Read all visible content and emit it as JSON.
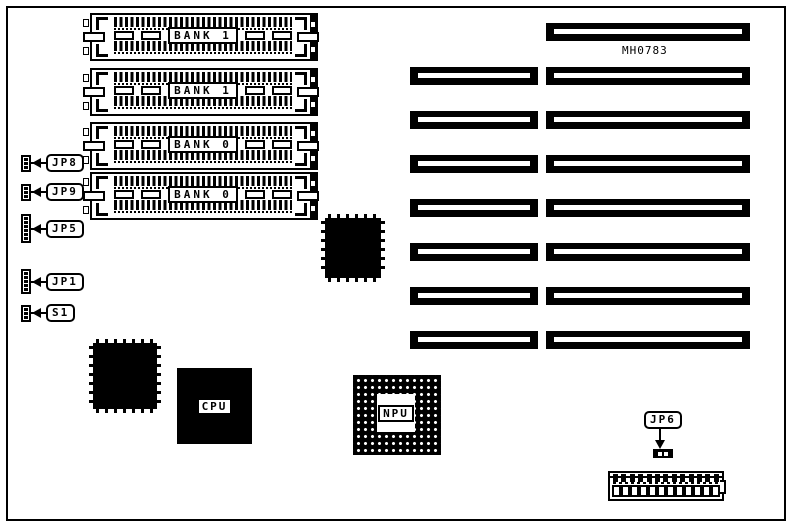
{
  "board": {
    "id_label": "MH0783",
    "colors": {
      "ink": "#000000",
      "paper": "#ffffff"
    }
  },
  "memory_banks": [
    {
      "label": "BANK 1"
    },
    {
      "label": "BANK 1"
    },
    {
      "label": "BANK 0"
    },
    {
      "label": "BANK 0"
    }
  ],
  "jumpers": [
    {
      "label": "JP8"
    },
    {
      "label": "JP9"
    },
    {
      "label": "JP5"
    },
    {
      "label": "JP1"
    },
    {
      "label": "S1"
    },
    {
      "label": "JP6"
    }
  ],
  "chips": {
    "cpu_label": "CPU",
    "npu_label": "NPU"
  },
  "expansion_slots": {
    "left_column_count": 7,
    "right_column_count": 8
  },
  "edge_connector": {
    "top_pin_count": 13,
    "bottom_cell_count": 12
  }
}
